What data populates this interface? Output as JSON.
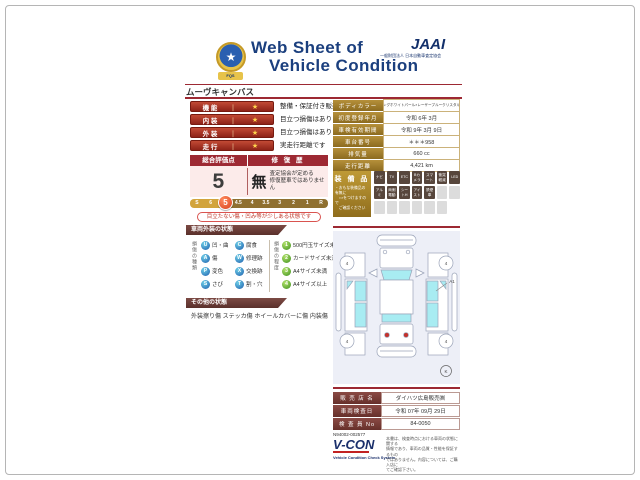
{
  "colors": {
    "maroon": "#9d2933",
    "gold": "#a8822c",
    "navy": "#1b3f7e",
    "glass_cyan": "#a8ecf2",
    "marker_red": "#d8431f"
  },
  "header": {
    "title_line1": "Web Sheet of",
    "title_line2": "Vehicle Condition",
    "emblem_text": "FQS",
    "emblem_star": "★",
    "org": "JAAI",
    "org_sub": "一般財団法人 日本自動車査定協会"
  },
  "vehicle_name": "ムーヴキャンバス",
  "ratings": [
    {
      "label": "機 能",
      "divider": "｜",
      "star": "★",
      "desc": "整備・保証付き販売です"
    },
    {
      "label": "内 装",
      "divider": "｜",
      "star": "★",
      "desc": "目立つ損傷はありません"
    },
    {
      "label": "外 装",
      "divider": "｜",
      "star": "★",
      "desc": "目立つ損傷はありません"
    },
    {
      "label": "走 行",
      "divider": "｜",
      "star": "★",
      "desc": "実走行距離です"
    }
  ],
  "evaluation": {
    "score_header": "総合評価点",
    "repair_header": "修 復 歴",
    "score": "5",
    "repair_value": "無",
    "repair_line1": "査定協会が定める",
    "repair_line2": "修復歴車ではありません",
    "scale": [
      "S",
      "6",
      "5",
      "4.5",
      "4",
      "3.5",
      "3",
      "2",
      "1",
      "R"
    ],
    "marker": "5",
    "note": "目立たない傷・凹み等が少しある状態です"
  },
  "exterior": {
    "title": "車両外装の状態",
    "types_label": "損傷の種類",
    "types": [
      {
        "code": "U",
        "label": "凹・曲"
      },
      {
        "code": "A",
        "label": "傷"
      },
      {
        "code": "P",
        "label": "変色"
      },
      {
        "code": "S",
        "label": "さび"
      },
      {
        "code": "C",
        "label": "腐食"
      },
      {
        "code": "W",
        "label": "修理跡"
      },
      {
        "code": "X",
        "label": "交換跡"
      },
      {
        "code": "T",
        "label": "割・穴"
      }
    ],
    "degrees_label": "損傷の程度",
    "degrees": [
      {
        "code": "1",
        "label": "500円玉サイズ未満"
      },
      {
        "code": "2",
        "label": "カードサイズ未満"
      },
      {
        "code": "3",
        "label": "A4サイズ未満"
      },
      {
        "code": "4",
        "label": "A4サイズ以上"
      }
    ]
  },
  "other": {
    "title": "その他の状態",
    "text": "外装擦り傷 ステッカ傷 ホイールカバーに傷 内装傷"
  },
  "vehicle_info": [
    {
      "label": "ボディカラー",
      "value": "シャイニングホワイトパール×レーザーブルークリスタルシャイン"
    },
    {
      "label": "初度登録年月",
      "value": "令和 6年 3月"
    },
    {
      "label": "車検有効期間",
      "value": "令和 9年 3月 9日"
    },
    {
      "label": "車台番号",
      "value": "＊＊＊958"
    },
    {
      "label": "排気量",
      "value": "660 cc"
    },
    {
      "label": "走行距離",
      "value": "4,421 km"
    }
  ],
  "equipment": {
    "title": "装 備 品",
    "note_line1": "・おもな装備品の有無に",
    "note_line2": "　○×をつけますので",
    "note_line3": "　ご確認ください",
    "row1": [
      "ナビ",
      "TV",
      "ETC",
      "Bカメラ",
      "スマート",
      "衝突軽減",
      "LED"
    ],
    "row2": [
      "アルミ",
      "両側電動",
      "シートH",
      "アイスト",
      "禁煙車"
    ]
  },
  "diagram": {
    "wheel_marks": [
      "4",
      "4",
      "4",
      "4"
    ],
    "annotation": "A1",
    "stamp": "K"
  },
  "dealer": {
    "rows": [
      {
        "label": "販 売 店 名",
        "value": "ダイハツ広島販売㈱"
      },
      {
        "label": "車両検査日",
        "value": "令和 07年 09月 29日"
      },
      {
        "label": "検 査 員 No",
        "value": "84-0050"
      }
    ]
  },
  "footer": {
    "serial": "N94002-002577",
    "logo": "V-CON",
    "logo_sub": "Vehicle Condition Check System",
    "disclaimer_line1": "本書は、検査時点における車両の状態に関する",
    "disclaimer_line2": "情報であり、車両の品質・性能を保証するもの",
    "disclaimer_line3": "ではありません。内容については、ご購入店に",
    "disclaimer_line4": "てご確認下さい。"
  }
}
